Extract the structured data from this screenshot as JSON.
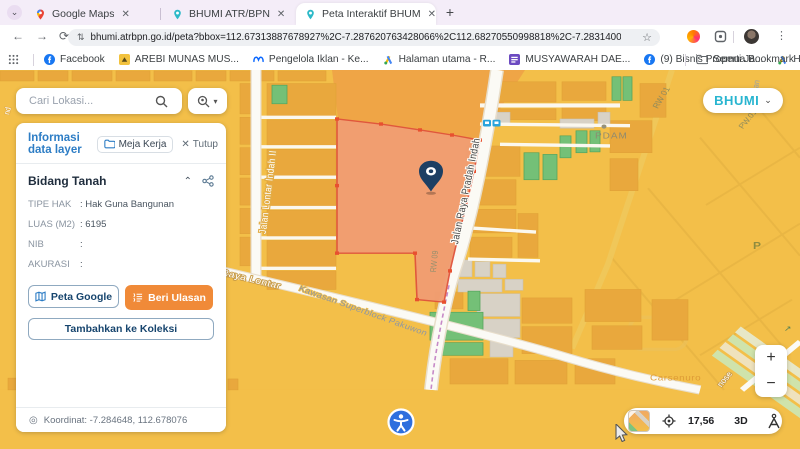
{
  "colors": {
    "accent_blue": "#2D7DC5",
    "button_orange": "#F08A38",
    "logo_teal": "#28B5D0",
    "map_base": "#F3BF49",
    "building_orange": "#E9A83D",
    "building_green": "#74C077",
    "parcel_fill": "#F19D72",
    "parcel_stroke": "#E0543C",
    "pin_navy": "#1D3F63",
    "tabstrip_bg": "#F4EDF8",
    "a11y_blue": "#2E6FDE"
  },
  "browser": {
    "tabs": [
      {
        "title": "Google Maps"
      },
      {
        "title": "BHUMI ATR/BPN"
      },
      {
        "title": "Peta Interaktif BHUMI ATR/BPN"
      }
    ],
    "new_tab": "+",
    "url": "bhumi.atrbpn.go.id/peta?bbox=112.67313887678927%2C-7.287620763428066%2C112.68270550998818%2C-7.283140043732985&height=645&width=1366...",
    "bookmarks": [
      {
        "label": "Facebook"
      },
      {
        "label": "AREBI MUNAS MUS..."
      },
      {
        "label": "Pengelola Iklan - Ke..."
      },
      {
        "label": "Halaman utama - R..."
      },
      {
        "label": "MUSYAWARAH DAE..."
      },
      {
        "label": "(9) Bisnis Properti Ja..."
      },
      {
        "label": "Halaman utama - R..."
      }
    ],
    "all_bookmarks": "Semua Bookmark"
  },
  "search": {
    "placeholder": "Cari Lokasi..."
  },
  "panel": {
    "title": "Informasi data layer",
    "meja_kerja": "Meja Kerja",
    "tutup": "Tutup",
    "section": "Bidang Tanah",
    "fields": [
      {
        "label": "TIPE HAK",
        "value": ": Hak Guna Bangunan"
      },
      {
        "label": "LUAS (M2)",
        "value": ": 6195"
      },
      {
        "label": "NIB",
        "value": ":"
      },
      {
        "label": "AKURASI",
        "value": ":"
      }
    ],
    "buttons": {
      "peta_google": "Peta Google",
      "beri_ulasan": "Beri Ulasan",
      "tambah_koleksi": "Tambahkan ke Koleksi"
    },
    "koordinat": "Koordinat: -7.284648, 112.678076"
  },
  "logo": {
    "text": "BHUMI"
  },
  "map": {
    "labels": {
      "lontar_indah": "Jalan Lontar Indah II",
      "pradah_indah": "Jalan Raya Pradah Indah",
      "raya_lontar": "Raya Lontar",
      "kawasan": "Kawasan Superblock Pakuwon",
      "rw01": "RW 01",
      "pw01": "PW.01",
      "rw09": "RW 09",
      "pdam": "PDAM",
      "babatan": "Babatan",
      "carsenuro": "Carsenuro",
      "nose": "nose",
      "nd": "nd",
      "p": "P",
      "arrow": "↗"
    },
    "controls": {
      "zoom_in": "+",
      "zoom_out": "−",
      "scale": "17,56",
      "mode_3d": "3D"
    }
  }
}
